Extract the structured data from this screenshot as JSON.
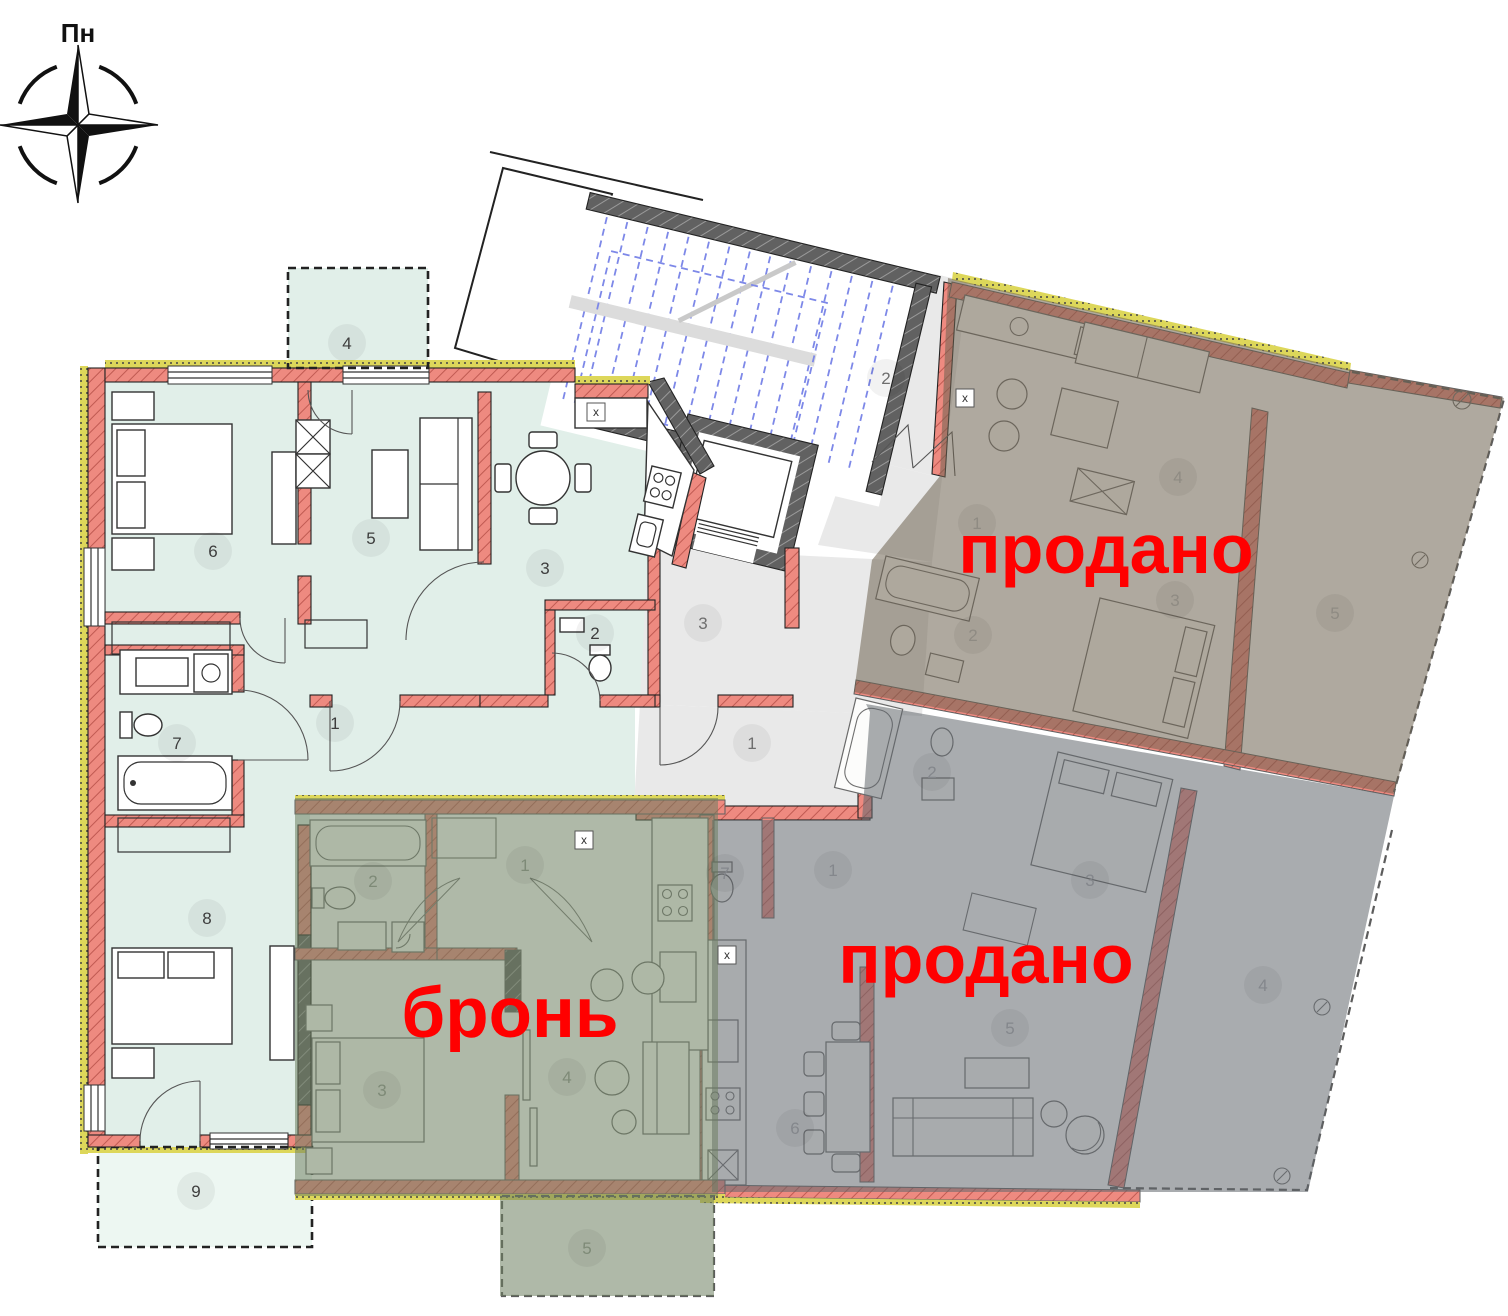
{
  "compass": {
    "label": "Пн"
  },
  "status_labels": [
    {
      "id": "sold-top",
      "text": "продано",
      "x": 1106,
      "y": 573,
      "size": 70
    },
    {
      "id": "sold-bottom",
      "text": "продано",
      "x": 986,
      "y": 983,
      "size": 70
    },
    {
      "id": "reserved",
      "text": "бронь",
      "x": 510,
      "y": 1037,
      "size": 71
    }
  ],
  "apartments": [
    {
      "id": "available",
      "status": "available"
    },
    {
      "id": "reserved",
      "status": "бронь"
    },
    {
      "id": "sold-top",
      "status": "продано"
    },
    {
      "id": "sold-bottom",
      "status": "продано"
    }
  ],
  "room_labels": {
    "available": [
      {
        "n": "1",
        "x": 335,
        "y": 723
      },
      {
        "n": "2",
        "x": 595,
        "y": 633
      },
      {
        "n": "3",
        "x": 545,
        "y": 568
      },
      {
        "n": "4",
        "x": 347,
        "y": 343
      },
      {
        "n": "5",
        "x": 371,
        "y": 538
      },
      {
        "n": "6",
        "x": 213,
        "y": 551
      },
      {
        "n": "7",
        "x": 177,
        "y": 743
      },
      {
        "n": "8",
        "x": 207,
        "y": 918
      },
      {
        "n": "9",
        "x": 196,
        "y": 1191
      }
    ],
    "common": [
      {
        "n": "1",
        "x": 752,
        "y": 743
      },
      {
        "n": "2",
        "x": 886,
        "y": 378
      },
      {
        "n": "3",
        "x": 703,
        "y": 623
      }
    ],
    "sold_top": [
      {
        "n": "1",
        "x": 977,
        "y": 523
      },
      {
        "n": "2",
        "x": 973,
        "y": 635
      },
      {
        "n": "3",
        "x": 1175,
        "y": 600
      },
      {
        "n": "4",
        "x": 1178,
        "y": 477
      },
      {
        "n": "5",
        "x": 1335,
        "y": 613
      }
    ],
    "sold_bottom": [
      {
        "n": "1",
        "x": 833,
        "y": 870
      },
      {
        "n": "2",
        "x": 932,
        "y": 772
      },
      {
        "n": "3",
        "x": 1090,
        "y": 880
      },
      {
        "n": "4",
        "x": 1263,
        "y": 985
      },
      {
        "n": "5",
        "x": 1010,
        "y": 1028
      },
      {
        "n": "6",
        "x": 795,
        "y": 1128
      },
      {
        "n": "7",
        "x": 725,
        "y": 873
      }
    ],
    "reserved": [
      {
        "n": "1",
        "x": 525,
        "y": 865
      },
      {
        "n": "2",
        "x": 373,
        "y": 881
      },
      {
        "n": "3",
        "x": 382,
        "y": 1090
      },
      {
        "n": "4",
        "x": 567,
        "y": 1077
      },
      {
        "n": "5",
        "x": 587,
        "y": 1248
      }
    ]
  },
  "x_markers": [
    {
      "t": "x",
      "x": 596,
      "y": 412
    },
    {
      "t": "x",
      "x": 584,
      "y": 840
    },
    {
      "t": "x",
      "x": 727,
      "y": 955
    },
    {
      "t": "x",
      "x": 965,
      "y": 398
    }
  ],
  "colors": {
    "status_text": "#ff0000",
    "available_floor": "#e1efe9",
    "terrace_floor": "#edf7f2",
    "corridor_floor": "#e9e9e9",
    "wall_salmon": "#ee8a80",
    "wall_dark": "#616161",
    "insulation_yellow": "#ddd75a",
    "stair_blue": "#7d88e8",
    "sold_top_tint": "#6e6250",
    "sold_bottom_tint": "#62676e",
    "reserved_tint": "#6e8060"
  }
}
